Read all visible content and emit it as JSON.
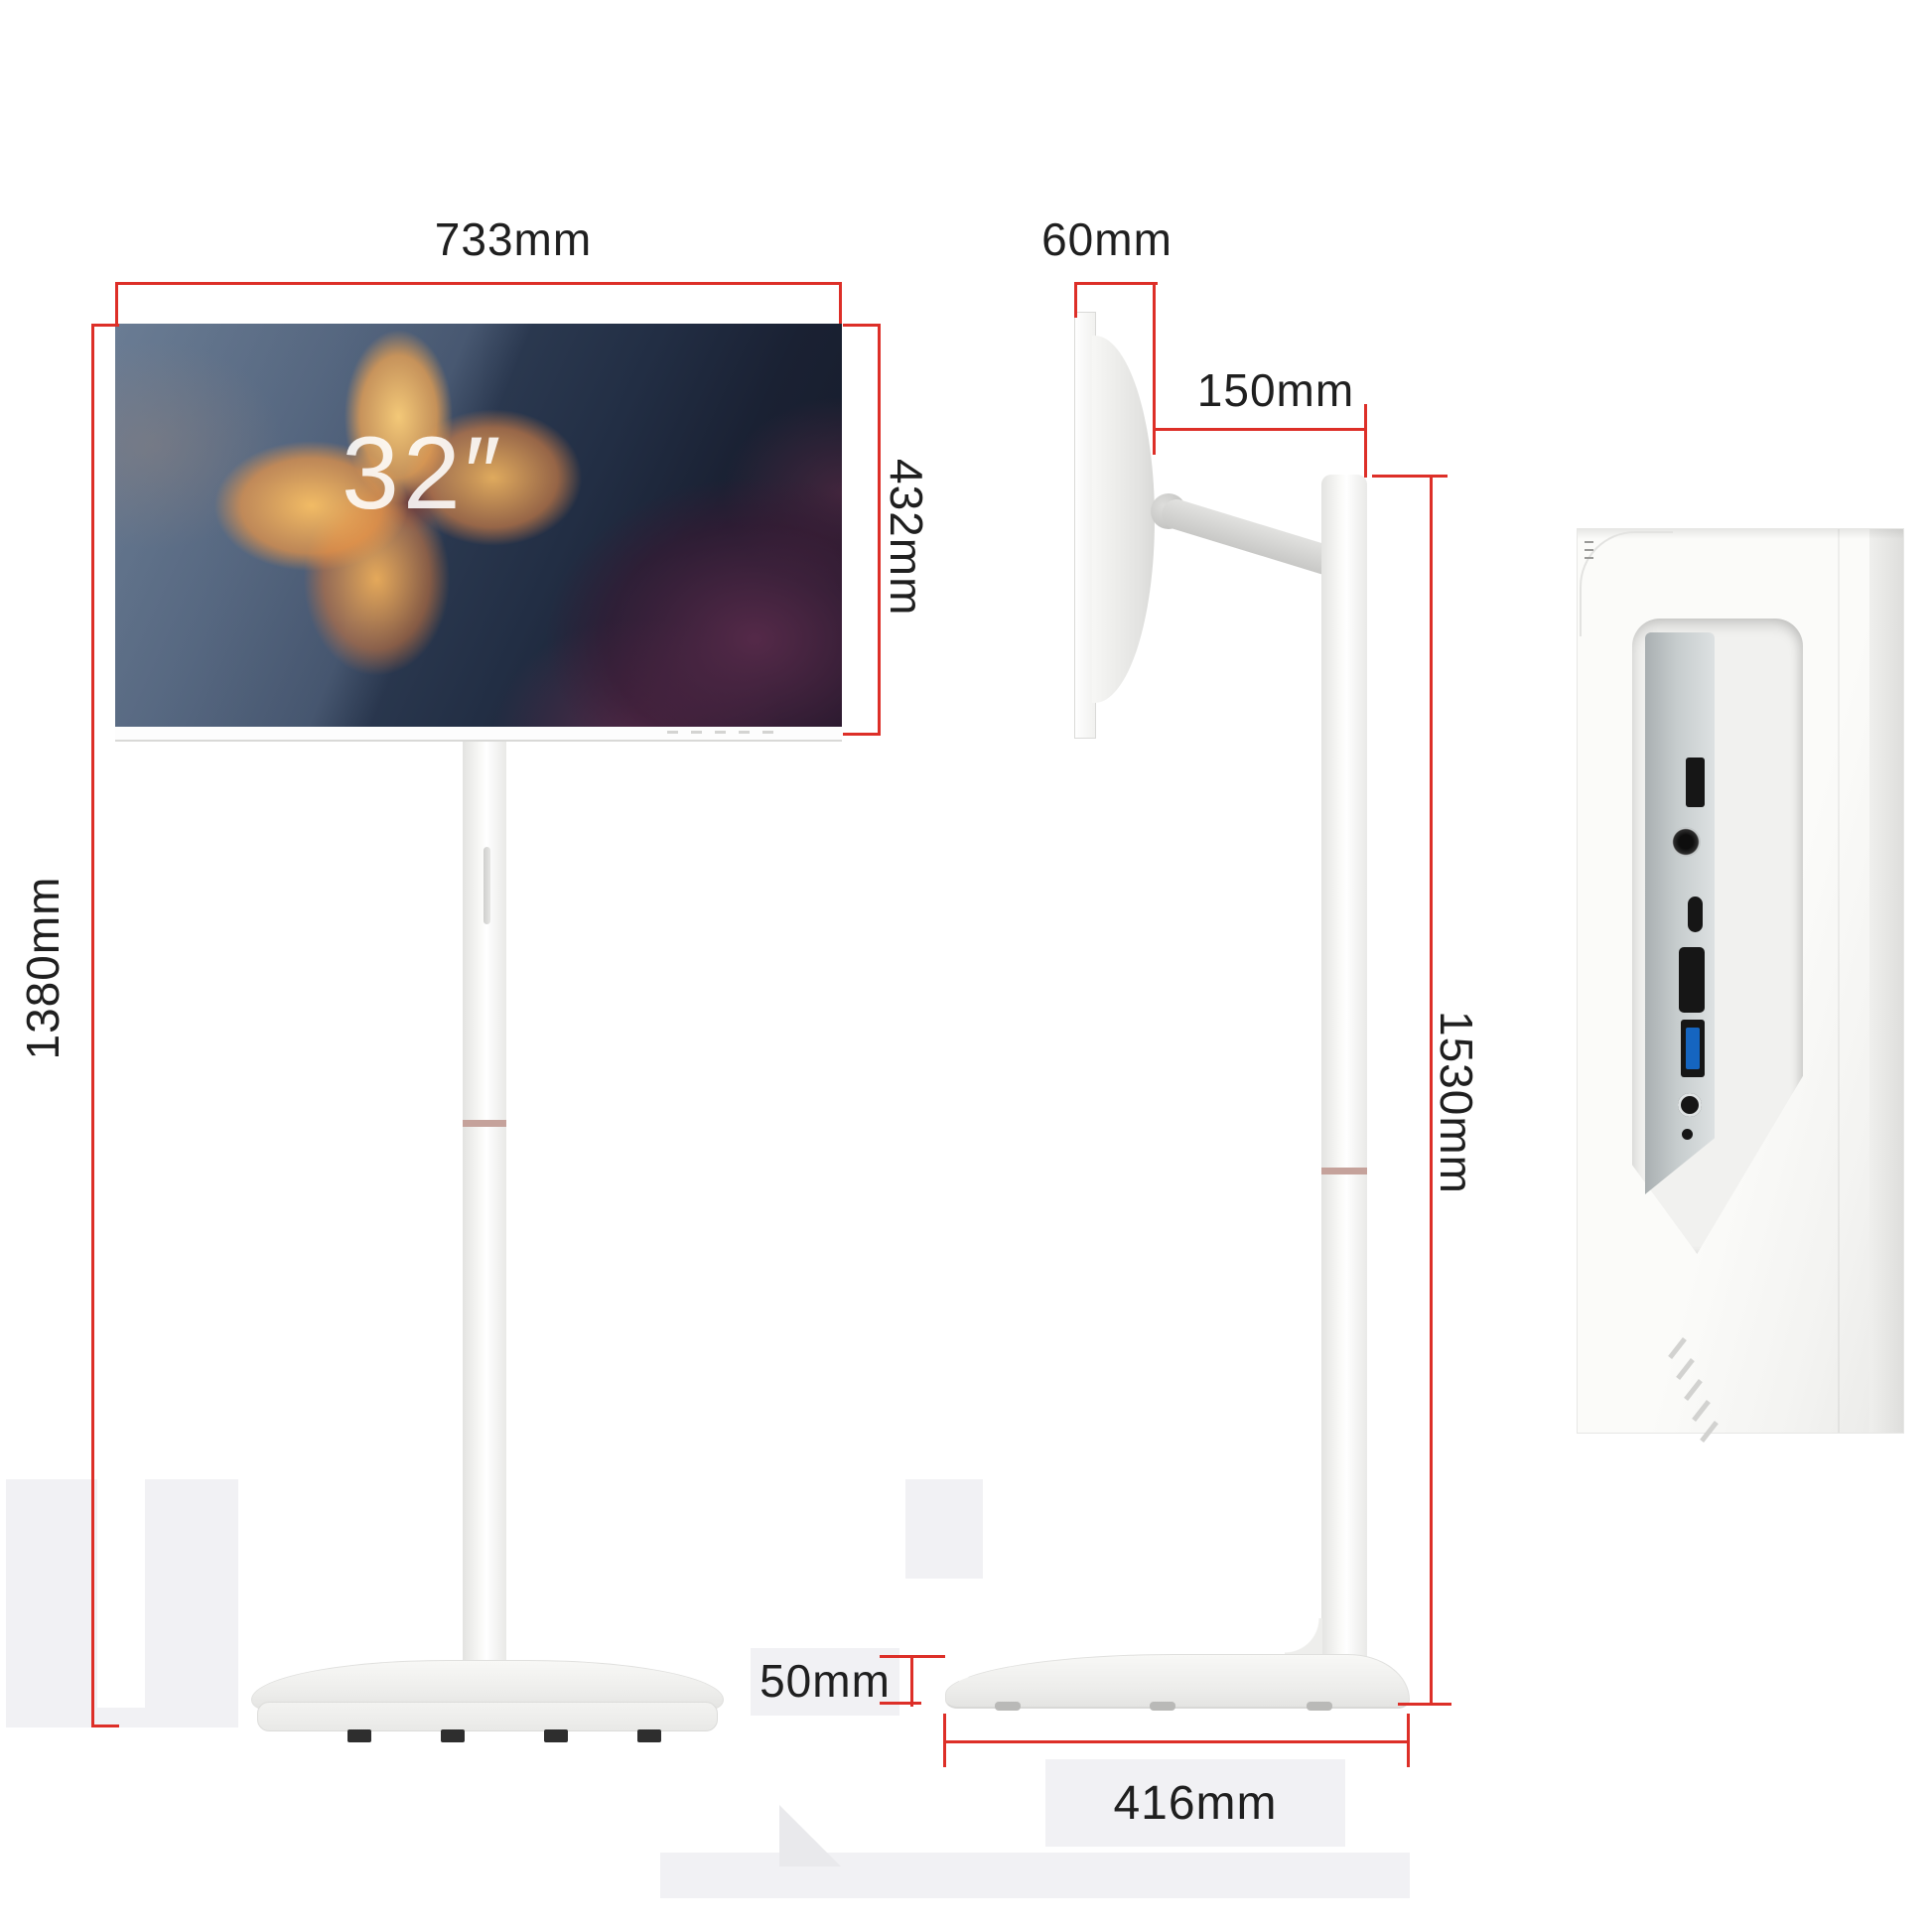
{
  "diagram": {
    "screen_size_label": "32″",
    "front": {
      "width": "733mm",
      "screen_height": "432mm",
      "total_height": "1380mm"
    },
    "side": {
      "screen_depth": "60mm",
      "arm_offset": "150mm",
      "stand_height": "1530mm",
      "base_height": "50mm",
      "base_depth": "416mm"
    }
  },
  "colors": {
    "dimension_line": "#dd2f28",
    "pole_ring": "#c5a29b",
    "usb3_blue": "#1565c0",
    "background_patch": "#f1f1f4"
  },
  "ports": [
    "usb-port",
    "dc-in-jack",
    "usb-c-port",
    "hdmi-port",
    "usb3-port",
    "audio-jack",
    "reset-hole"
  ]
}
